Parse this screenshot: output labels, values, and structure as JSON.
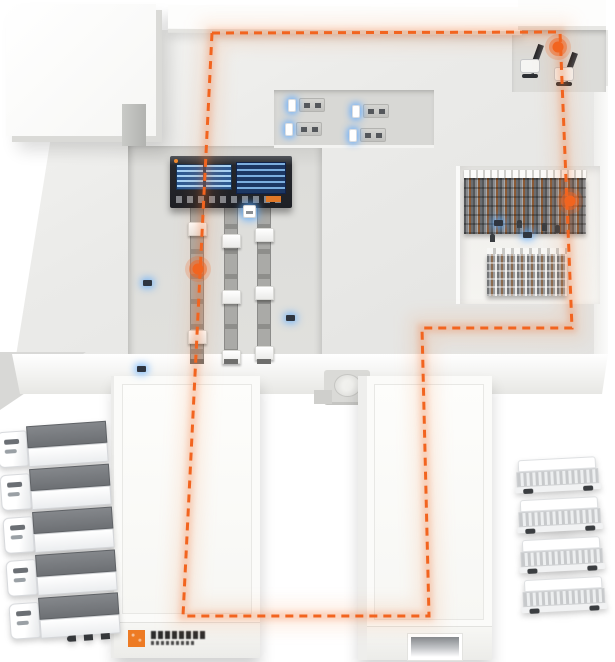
{
  "meta": {
    "description": "Isometric smart-logistics warehouse illustration: closed orange dashed AGV route loop over facility with monitoring board, three conveyor lines, high-bay and small racking, forklift dock, four workstations, IoT sensor dots, two shipping annex buildings, five semi-trailer trucks (left) and four box trucks (right)."
  },
  "palette": {
    "accent": "#f2641f",
    "accent_soft": "rgba(242,100,31,0.22)",
    "sensor_glow": "#5aa9ff",
    "floor": "#ebebe9",
    "board_dark": "#26282d",
    "screen_blue": "#2d5a93",
    "screen_deep": "#1c3763"
  },
  "route": {
    "stroke": "#f2641f",
    "width": 3,
    "dash": "8 6",
    "closed": true,
    "points": [
      [
        212,
        33
      ],
      [
        560,
        32
      ],
      [
        572,
        328
      ],
      [
        422,
        328
      ],
      [
        429,
        616
      ],
      [
        183,
        616
      ]
    ]
  },
  "nodes": [
    {
      "id": "node-dock",
      "x": 558,
      "y": 47
    },
    {
      "id": "node-rack",
      "x": 570,
      "y": 201
    },
    {
      "id": "node-conveyor",
      "x": 198,
      "y": 269
    }
  ],
  "sensors": [
    {
      "x": 147,
      "y": 283
    },
    {
      "x": 141,
      "y": 369
    },
    {
      "x": 290,
      "y": 318
    },
    {
      "x": 498,
      "y": 223
    },
    {
      "x": 527,
      "y": 235
    }
  ],
  "carts": [
    {
      "x": 249,
      "y": 211
    }
  ],
  "figures": [
    {
      "x": 519,
      "y": 227
    },
    {
      "x": 544,
      "y": 230
    },
    {
      "x": 557,
      "y": 232
    },
    {
      "x": 492,
      "y": 241
    }
  ],
  "workstations": [
    {
      "x": 288,
      "y": 98
    },
    {
      "x": 285,
      "y": 122
    },
    {
      "x": 352,
      "y": 104
    },
    {
      "x": 349,
      "y": 128
    }
  ],
  "conveyors": [
    {
      "x": 190,
      "packages": [
        222,
        330
      ]
    },
    {
      "x": 224,
      "packages": [
        234,
        290,
        350
      ]
    },
    {
      "x": 257,
      "packages": [
        228,
        286,
        346
      ]
    }
  ],
  "forklifts": [
    {
      "x": 518,
      "y": 44
    },
    {
      "x": 552,
      "y": 52
    }
  ],
  "fleet": {
    "left_count": 5,
    "right_count": 4
  },
  "brand": {
    "logo_color": "#ed7b24"
  }
}
